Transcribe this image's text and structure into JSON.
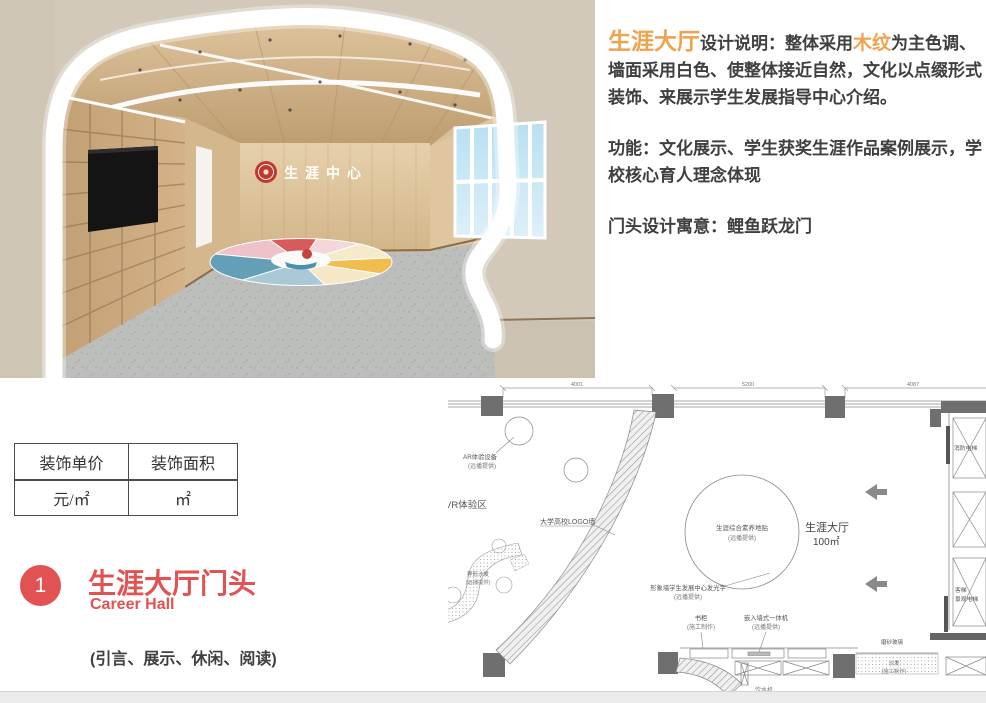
{
  "description": {
    "p1": [
      "生涯大厅",
      "设计说明：整体采用",
      "木纹",
      "为主色调、墙面采用白色、使整体接近自然，文化以点缀形式装饰、来展示学生发展指导中心介绍。"
    ],
    "p2": "功能：文化展示、学生获奖生涯作品案例展示，学校核心育人理念体现",
    "p3": "门头设计寓意：鲤鱼跃龙门"
  },
  "pricing_table": {
    "headers": [
      "装饰单价",
      "装饰面积"
    ],
    "values": [
      "元/㎡",
      "㎡"
    ]
  },
  "section": {
    "number": "1",
    "title": "生涯大厅门头",
    "subtitle": "Career Hall",
    "note": "(引言、展示、休闲、阅读)"
  },
  "render": {
    "logo_text": "生涯中心"
  },
  "floor_plan": {
    "dims": [
      "4001",
      "5200",
      "4087"
    ],
    "labels": {
      "ar_device_1": "AR体验设备",
      "ar_device_2": "(远播提供)",
      "vr_zone": "VR体验区",
      "logo_wall": "大学高校LOGO墙",
      "floor_sticker_1": "生涯综合素养地贴",
      "floor_sticker_2": "(远播提供)",
      "hall_name": "生涯大厅",
      "hall_area": "100㎡",
      "feature_wall_1": "形象墙学生发展中心发光字",
      "feature_wall_2": "(远播提供)",
      "bookcase_1": "书柜",
      "bookcase_2": "(施工制作)",
      "machine_1": "嵌入墙式一体机",
      "machine_2": "(远播提供)",
      "frosted_glass": "磨砂玻璃",
      "sofa_1": "沙发",
      "sofa_2": "(施工制作)",
      "shaped_sofa_1": "异形沙发",
      "shaped_sofa_2": "(远播提供)",
      "fire_elevator": "消防电梯",
      "passenger_elevator_1": "客梯",
      "passenger_elevator_2": "景观电梯",
      "water_dispenser": "饮水机"
    }
  },
  "colors": {
    "accent_orange": "#F0A24E",
    "title_red": "#E25252",
    "text_dark": "#3F3F3F"
  }
}
